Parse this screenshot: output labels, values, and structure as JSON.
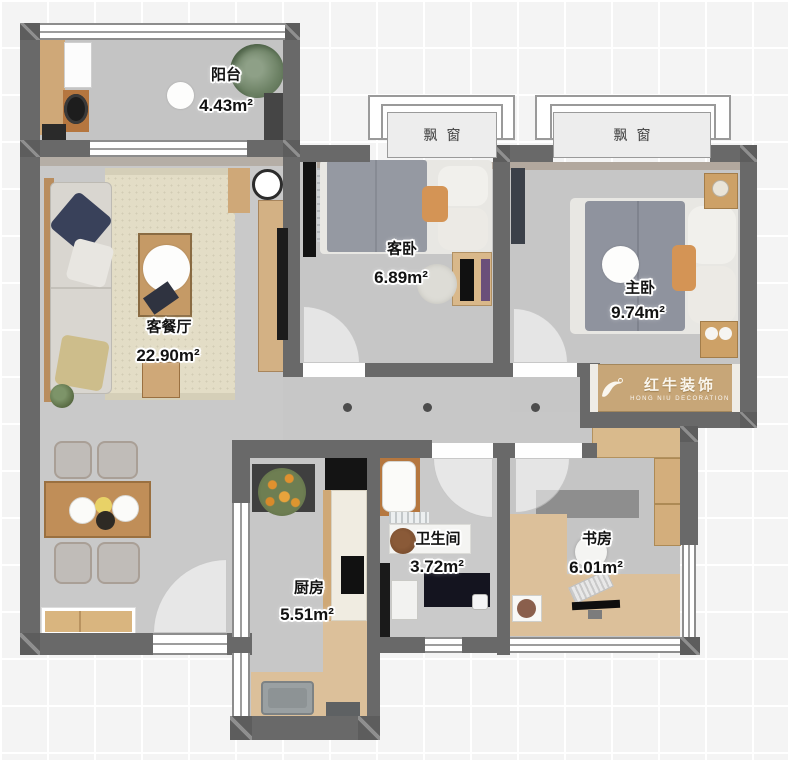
{
  "canvas": {
    "width": 788,
    "height": 760
  },
  "rooms": [
    {
      "id": "balcony",
      "name": "阳台",
      "area": "4.43m²"
    },
    {
      "id": "living-dining",
      "name": "客餐厅",
      "area": "22.90m²"
    },
    {
      "id": "guest-bedroom",
      "name": "客卧",
      "area": "6.89m²"
    },
    {
      "id": "master-bedroom",
      "name": "主卧",
      "area": "9.74m²"
    },
    {
      "id": "kitchen",
      "name": "厨房",
      "area": "5.51m²"
    },
    {
      "id": "bathroom",
      "name": "卫生间",
      "area": "3.72m²"
    },
    {
      "id": "study",
      "name": "书房",
      "area": "6.01m²"
    }
  ],
  "bay_windows": [
    {
      "label": "飘窗"
    },
    {
      "label": "飘窗"
    }
  ],
  "watermark": {
    "brand": "红牛装饰",
    "subtitle": "HONG NIU DECORATION",
    "logo_icon": "bull-logo-icon"
  },
  "corridor": {
    "light_count": 3
  },
  "colors": {
    "wall": "#696969",
    "floor": "#c7c7c7",
    "background_grid": "#f4f4f4",
    "wood": "#cfa878",
    "rug": "#e3ddc6",
    "accent_orange": "#d49455",
    "bay_label_bg": "#ededed",
    "label_text": "#121212",
    "watermark_text": "#faf6ee"
  }
}
